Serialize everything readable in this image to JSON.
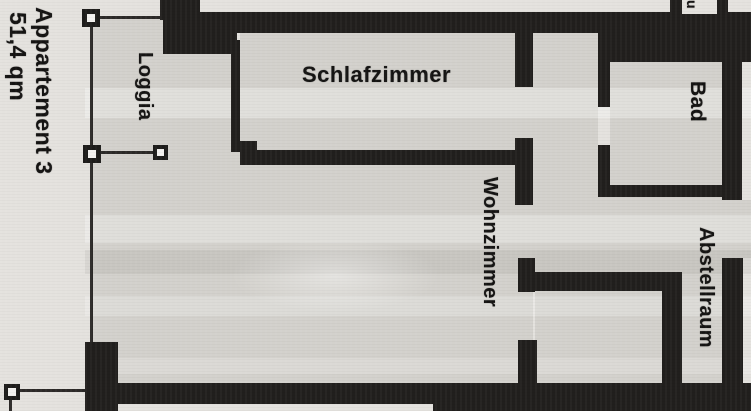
{
  "plan": {
    "title": "Appartement 3",
    "area": "51,4 qm",
    "rooms": {
      "loggia": "Loggia",
      "schlafzimmer": "Schlafzimmer",
      "bad": "Bad",
      "wohnzimmer": "Wohnzimmer",
      "abstellraum": "Abstellraum"
    },
    "edge_fragment": "u"
  },
  "colors": {
    "wall": "#211f1d",
    "paper": "#e4e2de",
    "floor": "#d3d1cc",
    "ink": "#141312"
  }
}
